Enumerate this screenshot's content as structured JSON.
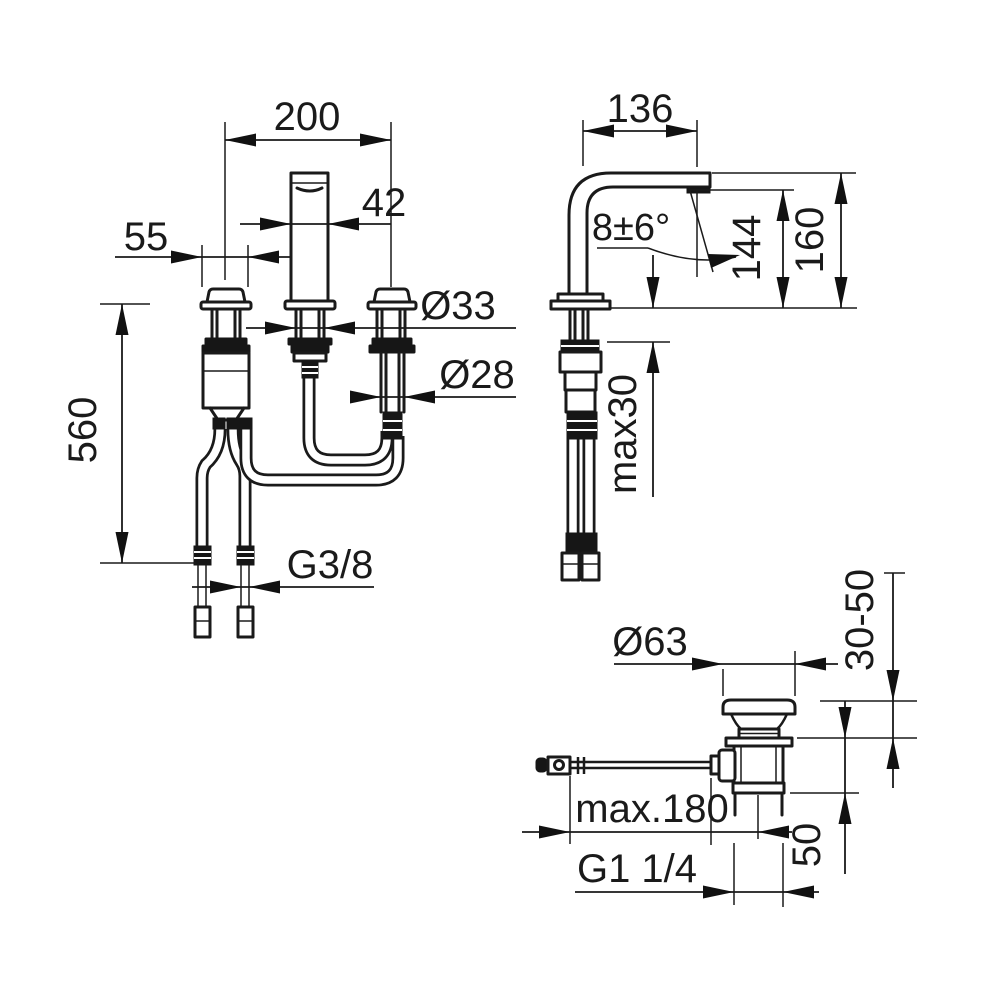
{
  "colors": {
    "line": "#1a1a1a",
    "background": "#ffffff"
  },
  "views": {
    "front": {
      "labels": {
        "spread": "200",
        "spout_width": "42",
        "rosette_dia": "55",
        "spout_shank_dia": "Ø33",
        "valve_shank_dia": "Ø28",
        "hose_length": "560",
        "supply_thread": "G3/8"
      }
    },
    "side": {
      "labels": {
        "projection": "136",
        "spray_angle": "8±6°",
        "outlet_height": "144",
        "total_height": "160",
        "deck_thickness": "max30"
      }
    },
    "waste": {
      "labels": {
        "plug_dia": "Ø63",
        "clamp_range": "30-50",
        "rod_length": "max.180",
        "thread": "G1 1/4",
        "body_depth": "50"
      }
    }
  }
}
